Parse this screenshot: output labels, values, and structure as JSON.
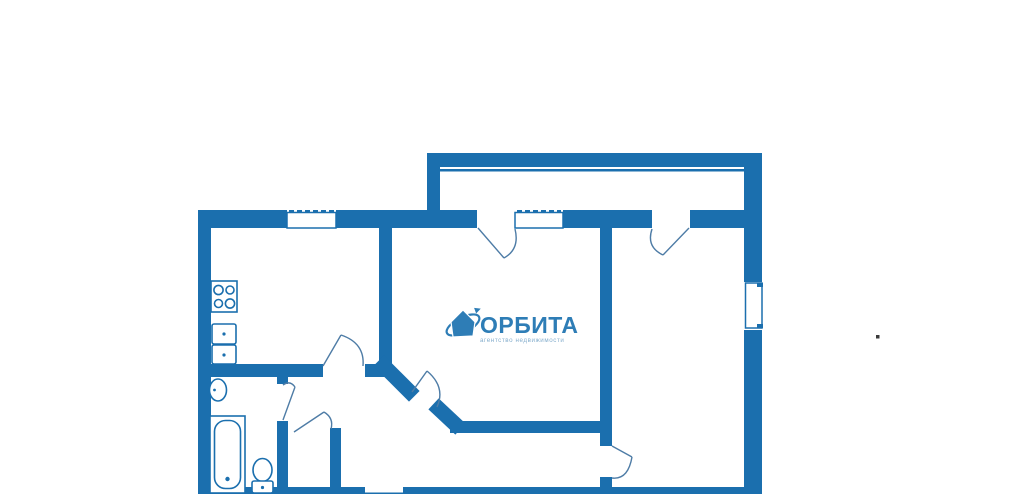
{
  "logo": {
    "name": "ОРБИТА",
    "tagline": "агентство недвижимости",
    "icon": "house-orbit-icon"
  },
  "colors": {
    "background": "#ffffff",
    "wall": "#1b6fae",
    "door_line": "#4e7ca6",
    "logo_text": "#2e7db6",
    "logo_tagline": "#85aecd",
    "artifact_dot": "#3a3a3a"
  },
  "icons": [
    "stove-icon",
    "kitchen-sink-icon",
    "wash-basin-icon",
    "bathtub-icon",
    "toilet-icon",
    "house-orbit-icon"
  ]
}
